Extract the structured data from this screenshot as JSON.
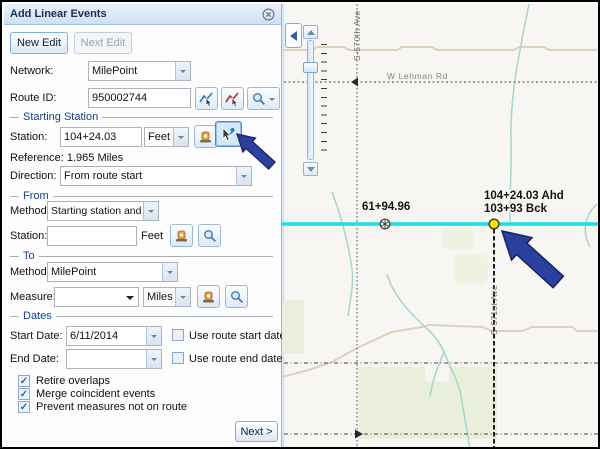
{
  "window": {
    "title": "Add Linear Events"
  },
  "toolbar": {
    "new_edit": "New Edit",
    "next_edit": "Next Edit"
  },
  "fields": {
    "network_label": "Network:",
    "network_value": "MilePoint",
    "route_id_label": "Route ID:",
    "route_id_value": "950002744"
  },
  "starting_station": {
    "title": "Starting Station",
    "station_label": "Station:",
    "station_value": "104+24.03",
    "units": "Feet",
    "reference": "Reference: 1.965 Miles",
    "direction_label": "Direction:",
    "direction_value": "From route start"
  },
  "from_section": {
    "title": "From",
    "method_label": "Method:",
    "method_value": "Starting station and offset",
    "station_label": "Station:",
    "station_value": "",
    "units": "Feet"
  },
  "to_section": {
    "title": "To",
    "method_label": "Method:",
    "method_value": "MilePoint",
    "measure_label": "Measure:",
    "measure_value": "",
    "units": "Miles"
  },
  "dates": {
    "title": "Dates",
    "start_label": "Start Date:",
    "start_value": "6/11/2014",
    "use_start": "Use route start date",
    "end_label": "End Date:",
    "end_value": "",
    "use_end": "Use route end date"
  },
  "options": [
    {
      "label": "Retire overlaps",
      "checked": true
    },
    {
      "label": "Merge coincident events",
      "checked": true
    },
    {
      "label": "Prevent measures not on route",
      "checked": true
    }
  ],
  "next_button": "Next >",
  "check_glyph": "✓",
  "icons": {
    "close": "circle-x",
    "dropdown": "▼",
    "collapse": "◀",
    "zoom-in": "▲",
    "zoom-out": "▼",
    "search": "magnifier",
    "select-route": "cursor-blue-line",
    "clear-route": "cursor-red-line",
    "station-tool": "orange-station",
    "pick-on-map": "cursor-point"
  },
  "map": {
    "station_marker_label": "61+94.96",
    "selected_point_label_line1": "104+24.03 Ahd",
    "selected_point_label_line2": "103+93 Bck",
    "road_horizontal": "W Lehman Rd",
    "road_vertical_left": "S-570th Ave",
    "road_vertical_right": "S-571st Ave",
    "colors": {
      "route": "#17dfe8",
      "selected_point": "#ffe400",
      "annotation_arrow": "#2b3f9e",
      "stream": "#a6d4ce",
      "field_fill": "#e9efdb",
      "road_minor": "#dbd2bd"
    }
  }
}
